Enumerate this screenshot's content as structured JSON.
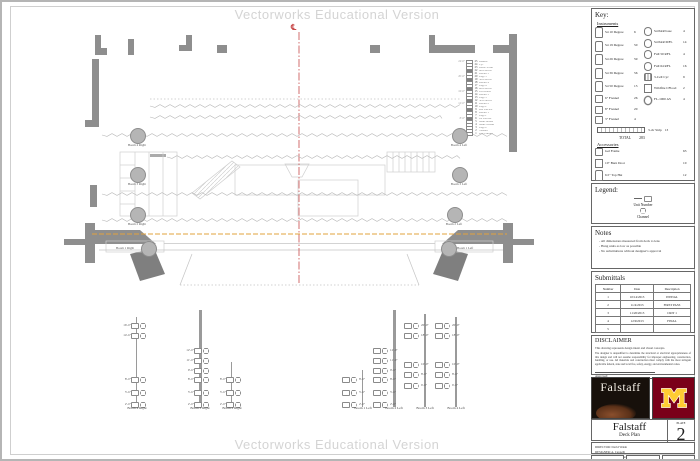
{
  "watermark": {
    "text": "Vectorworks Educational Version"
  },
  "plan": {
    "centerline_symbol": "℄",
    "boom_circles": [
      {
        "label": "Boom 4 Right"
      },
      {
        "label": "Boom 3 Right"
      },
      {
        "label": "Boom 2 Right"
      },
      {
        "label": "Boom 1 Right"
      },
      {
        "label": "Boom 4 Left"
      },
      {
        "label": "Boom 3 Left"
      },
      {
        "label": "Boom 2 Left"
      },
      {
        "label": "Boom 1 Left"
      }
    ],
    "linesets": [
      {
        "num": "25",
        "label": "Bounce",
        "dim": "24'-0\"",
        "filled": "0"
      },
      {
        "num": "24",
        "label": "Cyc",
        "dim": "",
        "filled": "0"
      },
      {
        "num": "23",
        "label": "Black Scrim",
        "dim": "",
        "filled": "0"
      },
      {
        "num": "22",
        "label": "6th Electric",
        "dim": "",
        "filled": "1"
      },
      {
        "num": "21",
        "label": "Border 5",
        "dim": "",
        "filled": "0"
      },
      {
        "num": "20",
        "label": "Legs 5",
        "dim": "20'-6\"",
        "filled": "0"
      },
      {
        "num": "19",
        "label": "5th Electric",
        "dim": "",
        "filled": "1"
      },
      {
        "num": "18",
        "label": "Border 4",
        "dim": "",
        "filled": "0"
      },
      {
        "num": "17",
        "label": "Legs 4",
        "dim": "",
        "filled": "0"
      },
      {
        "num": "16",
        "label": "4th Electric",
        "dim": "",
        "filled": "1"
      },
      {
        "num": "15",
        "label": "Full Black",
        "dim": "16'-0\"",
        "filled": "0"
      },
      {
        "num": "14",
        "label": "Border 3",
        "dim": "",
        "filled": "0"
      },
      {
        "num": "13",
        "label": "Legs 3",
        "dim": "",
        "filled": "0"
      },
      {
        "num": "12",
        "label": "3rd Electric",
        "dim": "",
        "filled": "1"
      },
      {
        "num": "11",
        "label": "Border 2",
        "dim": "12'-0\"",
        "filled": "0"
      },
      {
        "num": "10",
        "label": "Legs 2",
        "dim": "",
        "filled": "0"
      },
      {
        "num": "9",
        "label": "2nd Electric",
        "dim": "",
        "filled": "1"
      },
      {
        "num": "8",
        "label": "Border 1",
        "dim": "",
        "filled": "0"
      },
      {
        "num": "7",
        "label": "Legs 1",
        "dim": "",
        "filled": "0"
      },
      {
        "num": "6",
        "label": "1st Electric",
        "dim": "8'-6\"",
        "filled": "1"
      },
      {
        "num": "5",
        "label": "Main Border",
        "dim": "",
        "filled": "0"
      },
      {
        "num": "4",
        "label": "Main Curtain",
        "dim": "",
        "filled": "0"
      },
      {
        "num": "3",
        "label": "Legs 0",
        "dim": "",
        "filled": "0"
      },
      {
        "num": "2",
        "label": "Valance",
        "dim": "4'-0\"",
        "filled": "0"
      },
      {
        "num": "1",
        "label": "Fire Curtain",
        "dim": "",
        "filled": "0"
      }
    ]
  },
  "key": {
    "title": "Key:",
    "instruments_heading": "Instruments",
    "left_items": [
      {
        "icon": "ellipsoidal",
        "name": "S4 10 Degree",
        "count": "6"
      },
      {
        "icon": "ellipsoidal",
        "name": "S4 19 Degree",
        "count": "50"
      },
      {
        "icon": "ellipsoidal",
        "name": "S4 26 Degree",
        "count": "59"
      },
      {
        "icon": "ellipsoidal",
        "name": "S4 36 Degree",
        "count": "56"
      },
      {
        "icon": "ellipsoidal",
        "name": "S4 50 Degree",
        "count": "13"
      },
      {
        "icon": "fresnel",
        "name": "6\" Fresnel",
        "count": "26"
      },
      {
        "icon": "fresnel",
        "name": "8\" Fresnel",
        "count": "20"
      },
      {
        "icon": "fresnel",
        "name": "3\" Fresnel",
        "count": "4"
      }
    ],
    "right_items": [
      {
        "icon": "par",
        "name": "S4 PAR base",
        "count": "4"
      },
      {
        "icon": "par",
        "name": "S4 PAR MFL",
        "count": "14"
      },
      {
        "icon": "par",
        "name": "Full 50 RFL",
        "count": "4"
      },
      {
        "icon": "par",
        "name": "Full 64 RFL",
        "count": "16"
      },
      {
        "icon": "cyc",
        "name": "3-Cell Cyc",
        "count": "9"
      },
      {
        "icon": "wildfire",
        "name": "Wildfire CFlood",
        "count": "2"
      },
      {
        "icon": "moving",
        "name": "FL-1000 AS",
        "count": "4"
      }
    ],
    "strip_item": {
      "name": "3-cir Strip",
      "count": "13"
    },
    "total_label": "TOTAL",
    "total_count": "283",
    "accessories_heading": "Accessories",
    "accessories": [
      {
        "icon": "fresnel",
        "name": "Gel Frame",
        "count": "63"
      },
      {
        "icon": "wildfire",
        "name": "10\" Barn Door",
        "count": "10"
      },
      {
        "icon": "ellipsoidal",
        "name": "6.5\" Top Hat",
        "count": "12"
      }
    ]
  },
  "legend": {
    "title": "Legend:",
    "unit_number_label": "Unit Number",
    "channel_label": "Channel"
  },
  "notes": {
    "title": "Notes",
    "items": [
      "All dimensions measured from deck to lens",
      "Hang units as low as possible",
      "No substitutions without designer's approval"
    ]
  },
  "submittals": {
    "title": "Submittals",
    "columns": [
      "Number",
      "Date",
      "Description"
    ],
    "rows": [
      {
        "number": "1",
        "date": "10/14/2013",
        "description": "INITIAL"
      },
      {
        "number": "2",
        "date": "11/4/2013",
        "description": "FIRST PASS"
      },
      {
        "number": "3",
        "date": "11/20/2013",
        "description": "CRIT 1"
      },
      {
        "number": "4",
        "date": "12/9/2013",
        "description": "FINAL"
      },
      {
        "number": "5",
        "date": "",
        "description": ""
      }
    ]
  },
  "disclaimer": {
    "title": "DISCLAIMER",
    "intro": "This drawing represents design intent and visual concepts.",
    "body": "The designer is unqualified to determine the structural or electrical appropriateness of this design and will not assume responsibility for improper engineering, construction, handling, or use. All materials and construction must comply with the most stringent applicable federal, state and local fire, safety, energy, and environmental codes.",
    "signature_label": "Approved:"
  },
  "titleblock": {
    "falstaff_logo_text": "Falstaff",
    "minnesota_logo": "Block M",
    "show_title": "Falstaff",
    "sheet_title": "Deck Plan",
    "plate_label": "PLATE",
    "plate_number": "2",
    "plate_of": "OF 6",
    "info_lines": [
      "DIRECTOR: David Walsh",
      "DESIGNER: A. Cappelli",
      "VENUE: TMCH Ted Mann Concert Hall"
    ],
    "date": "DATE: 10/14/2013",
    "scale": "SCALE: 1/4\" = 1'-0\"",
    "drawn_by": "DRAWN BY: AC"
  },
  "boom_elevations": [
    {
      "name": "Boom 4 Right",
      "units": [
        "16'-0\"",
        "14'-6\"",
        "8'-0\"",
        "5'-6\"",
        "2'-0\""
      ]
    },
    {
      "name": "Boom 3 Right",
      "units": [
        "12'-0\"",
        "11'-0\"",
        "9'-6\"",
        "8'-0\"",
        "5'-6\"",
        "2'-0\""
      ]
    },
    {
      "name": "Boom 2 Right",
      "units": [
        "8'-0\"",
        "5'-6\"",
        "2'-0\""
      ]
    },
    {
      "name": "Boom 1 Left",
      "units": [
        "8'-0\"",
        "5'-6\"",
        "2'-0\""
      ]
    },
    {
      "name": "Boom 2 Left",
      "units": [
        "12'-0\"",
        "11'-0\"",
        "9'-6\"",
        "8'-0\"",
        "5'-6\"",
        "2'-0\""
      ]
    },
    {
      "name": "Boom 3 Left",
      "units": [
        "20'-0\"",
        "18'-0\"",
        "10'-0\"",
        "8'-0\"",
        "6'-0\""
      ]
    },
    {
      "name": "Boom 4 Left",
      "units": [
        "20'-0\"",
        "18'-0\"",
        "10'-0\"",
        "8'-0\"",
        "6'-0\""
      ]
    }
  ],
  "colors": {
    "centerline": "#c84b4b",
    "plaster_line": "#e2a33e",
    "wall": "#8e8e8e",
    "maroon": "#7a0019",
    "gold": "#ffcc33"
  }
}
